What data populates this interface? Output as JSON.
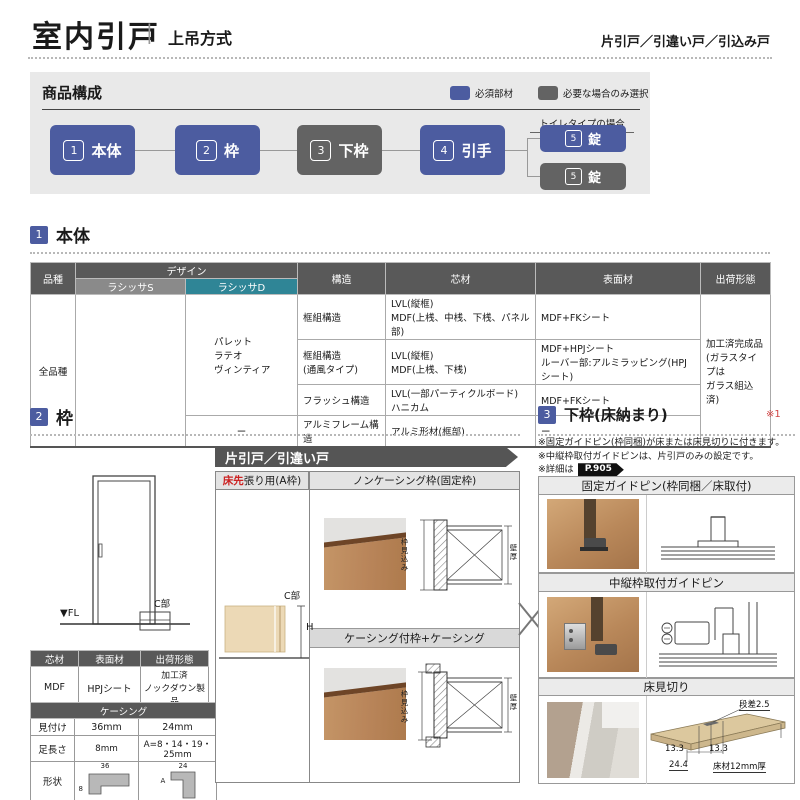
{
  "colors": {
    "accent_blue": "#4c5ca0",
    "accent_gray": "#636363",
    "teal": "#2f8596",
    "red": "#cc2222",
    "table_header": "#595959"
  },
  "header": {
    "title": "室内引戸",
    "separator": "|",
    "subtitle": "上吊方式",
    "category": "片引戸／引違い戸／引込み戸"
  },
  "composition": {
    "title": "商品構成",
    "legend_required": "必須部材",
    "legend_optional": "必要な場合のみ選択",
    "toilet_case": "トイレタイプの場合",
    "items": [
      {
        "num": "1",
        "label": "本体"
      },
      {
        "num": "2",
        "label": "枠"
      },
      {
        "num": "3",
        "label": "下枠"
      },
      {
        "num": "4",
        "label": "引手"
      }
    ],
    "lock_required": {
      "num": "5",
      "label": "錠"
    },
    "lock_optional": {
      "num": "5",
      "label": "錠"
    }
  },
  "section_body": {
    "num": "1",
    "title": "本体",
    "table": {
      "h_category": "品種",
      "h_design": "デザイン",
      "h_series_s": "ラシッサS",
      "h_series_d": "ラシッサD",
      "h_structure": "構造",
      "h_core": "芯材",
      "h_surface": "表面材",
      "h_shipping": "出荷形態",
      "category": "全品種",
      "design_d": "パレット\nラテオ\nヴィンティア",
      "design_d_last": "ー",
      "rows": [
        {
          "structure": "框組構造",
          "core": "LVL(縦框)\nMDF(上桟、中桟、下桟、パネル部)",
          "surface": "MDF+FKシート"
        },
        {
          "structure": "框組構造\n(通風タイプ)",
          "core": "LVL(縦框)\nMDF(上桟、下桟)",
          "surface": "MDF+HPJシート\nルーバー部:アルミラッピング(HPJシート)"
        },
        {
          "structure": "フラッシュ構造",
          "core": "LVL(一部パーティクルボード)\nハニカム",
          "surface": "MDF+FKシート"
        },
        {
          "structure": "アルミフレーム構造",
          "core": "アルミ形材(框部)",
          "surface": "ー"
        }
      ],
      "shipping": "加工済完成品\n(ガラスタイプは\nガラス組込済)"
    }
  },
  "section_frame": {
    "num": "2",
    "title": "枠",
    "elevation": {
      "fl": "▼FL",
      "c_part": "C部"
    },
    "spec_table": {
      "h_core": "芯材",
      "h_surface": "表面材",
      "h_shipping": "出荷形態",
      "core": "MDF",
      "surface": "HPJシート",
      "shipping": "加工済\nノックダウン製品"
    },
    "casing_table": {
      "title": "ケーシング",
      "row1": {
        "label": "見付け",
        "v1": "36mm",
        "v2": "24mm"
      },
      "row2": {
        "label": "足長さ",
        "v1": "8mm",
        "v2": "A=8・14・19・25mm"
      },
      "row3": {
        "label": "形状",
        "dim1_top": "36",
        "dim1_side": "8",
        "dim2_top": "24",
        "dim2_side": "A"
      }
    },
    "panel": {
      "banner": "片引戸／引違い戸",
      "col1_red": "床先",
      "col1_rest": "張り用(A枠)",
      "col2_header": "ノンケーシング枠(固定枠)",
      "sub_header": "ケーシング付枠+ケーシング",
      "dim_depth": "枠見込み",
      "dim_wall": "壁厚",
      "c_part": "C部",
      "h_dim": "H"
    }
  },
  "section_bottom": {
    "num": "3",
    "title": "下枠(床納まり)",
    "ref_mark": "※1",
    "note1": "※固定ガイドピン(枠同梱)が床または床見切りに付きます。",
    "note2": "※中縦枠取付ガイドピンは、片引戸のみの設定です。",
    "note3": "※詳細は",
    "page_ref": "P.905",
    "box1_title": "固定ガイドピン(枠同梱／床取付)",
    "box2_title": "中縦枠取付ガイドピン",
    "box3_title": "床見切り",
    "floor_diagram": {
      "step": "段差2.5",
      "dim_left": "13.3",
      "dim_right": "13.3",
      "dim_total": "24.4",
      "material": "床材12mm厚"
    }
  },
  "icons": {
    "fl_marker": "▼",
    "combination_cross": "✕",
    "page_tag_shape": "black-arrow-tag"
  }
}
